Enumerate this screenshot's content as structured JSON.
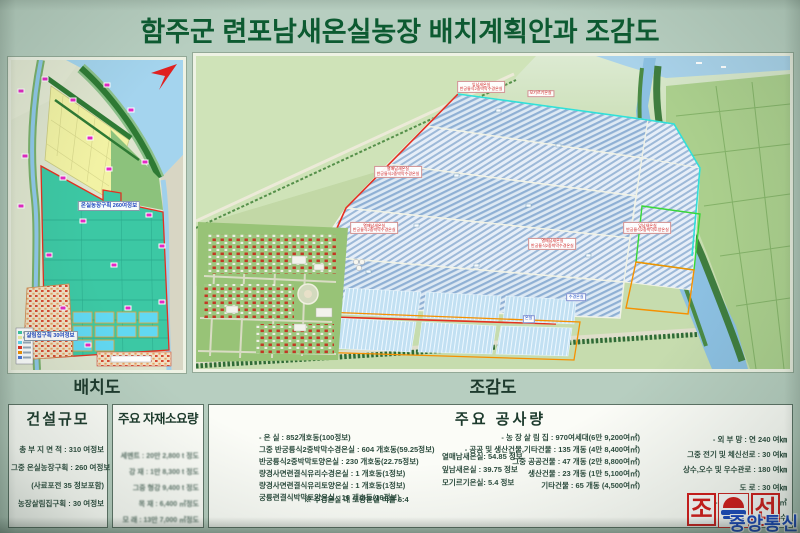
{
  "title": "함주군 련포남새온실농장 배치계획안과 조감도",
  "captions": {
    "layout_map": "배치도",
    "aerial_view": "조감도"
  },
  "map": {
    "greenhouse_label": "온실농장구획 260여정보",
    "housing_label": "살림집구획 30여정보",
    "markers": [
      {
        "x": 6,
        "y": 10
      },
      {
        "x": 20,
        "y": 6
      },
      {
        "x": 36,
        "y": 13
      },
      {
        "x": 56,
        "y": 8
      },
      {
        "x": 70,
        "y": 16
      },
      {
        "x": 46,
        "y": 25
      },
      {
        "x": 8,
        "y": 31
      },
      {
        "x": 30,
        "y": 38
      },
      {
        "x": 57,
        "y": 35
      },
      {
        "x": 78,
        "y": 33
      },
      {
        "x": 6,
        "y": 47
      },
      {
        "x": 42,
        "y": 52
      },
      {
        "x": 80,
        "y": 50
      },
      {
        "x": 22,
        "y": 63
      },
      {
        "x": 60,
        "y": 66
      },
      {
        "x": 88,
        "y": 60
      },
      {
        "x": 30,
        "y": 80
      },
      {
        "x": 68,
        "y": 80
      },
      {
        "x": 88,
        "y": 78
      },
      {
        "x": 45,
        "y": 92
      }
    ]
  },
  "aerial": {
    "labels": [
      {
        "x": 34,
        "y": 37,
        "c": "r",
        "t1": "열매남새온실",
        "t2": "반궁륭식2중박막수경온실"
      },
      {
        "x": 48,
        "y": 10,
        "c": "r",
        "t1": "잎남새온실",
        "t2": "반궁륭식2중박막수경온실"
      },
      {
        "x": 30,
        "y": 55,
        "c": "r",
        "t1": "열매남새온실",
        "t2": "반궁륭식2중박막수경온실"
      },
      {
        "x": 60,
        "y": 60,
        "c": "r",
        "t1": "열매남새온실",
        "t2": "반궁륭식2중박막수경온실"
      },
      {
        "x": 76,
        "y": 55,
        "c": "r",
        "t1": "잎남새온실",
        "t2": "반궁륭식2중박막토양온실"
      },
      {
        "x": 58,
        "y": 12,
        "c": "r",
        "t1": "모기르기온실",
        "t2": ""
      },
      {
        "x": 64,
        "y": 77,
        "c": "b",
        "t1": "수경온실",
        "t2": ""
      },
      {
        "x": 56,
        "y": 84,
        "c": "b",
        "t1": "온실",
        "t2": ""
      }
    ]
  },
  "construction_scale": {
    "heading": "건설규모",
    "rows": [
      "총 부 지 면 적 : 310 여정보",
      "그중 온실농장구획 : 260 여정보",
      "(사료포전 35 정보포함)",
      "농장살림집구획 : 30  여정보"
    ]
  },
  "materials": {
    "heading": "주요 자재소요량",
    "rows": [
      "세멘트 : 20만 2,800 t 정도",
      "강  재 : 1만 8,300 t 정도",
      "그중 형강  9,400 t 정도",
      "목  재 :  6,400 ㎥정도",
      "모  래 : 13만 7,000 ㎥정도"
    ]
  },
  "works": {
    "heading": "주요 공사량",
    "col1": [
      "- 온  실 : 852개호동(100정보)",
      "그중 반궁륭식2중박막수경온실    : 604 개호동(59.25정보)",
      "반궁륭식2중박막토양온실    : 230 개호동(22.75정보)",
      "량경사면련결식유리수경온실 : 1    개호동(1정보)",
      "량경사면련결식유리토양온실 : 1    개호동(1정보)",
      "궁륭련결식박막토양온실     : 16   개호동(16정보)"
    ],
    "note": "※ 수경온실 대 토양온실 비률  6:4",
    "col2": [
      "열매남새온실: 54.85 정보",
      "잎남새온실  : 39.75 정보",
      "모기르기온실: 5.4    정보"
    ],
    "col3": [
      "- 농 장 살 림 집          : 970여세대(6만 9,200여㎡)",
      "- 공공 및 생산건물,기타건물 : 135  개동 (4만 8,400여㎡)",
      "그중 공공건물 :  47  개동 (2만 8,800여㎡)",
      "생산건물 :  23  개동 (1만 5,100여㎡)",
      "기타건물 :  65  개동      (4,500여㎡)"
    ],
    "col4": [
      "- 외  부  망             : 연 240  여㎞",
      "그중 전기 및 체신선로 :    30  여㎞",
      "상수,오수 및 우수관로 :   180  여㎞",
      "도             로 :    30  여㎞",
      "- 성  토  량             :  150 여만㎥",
      "- 로  력  공  수"
    ]
  },
  "logo": {
    "cho": "조",
    "son": "선",
    "agency": "중앙통신"
  }
}
